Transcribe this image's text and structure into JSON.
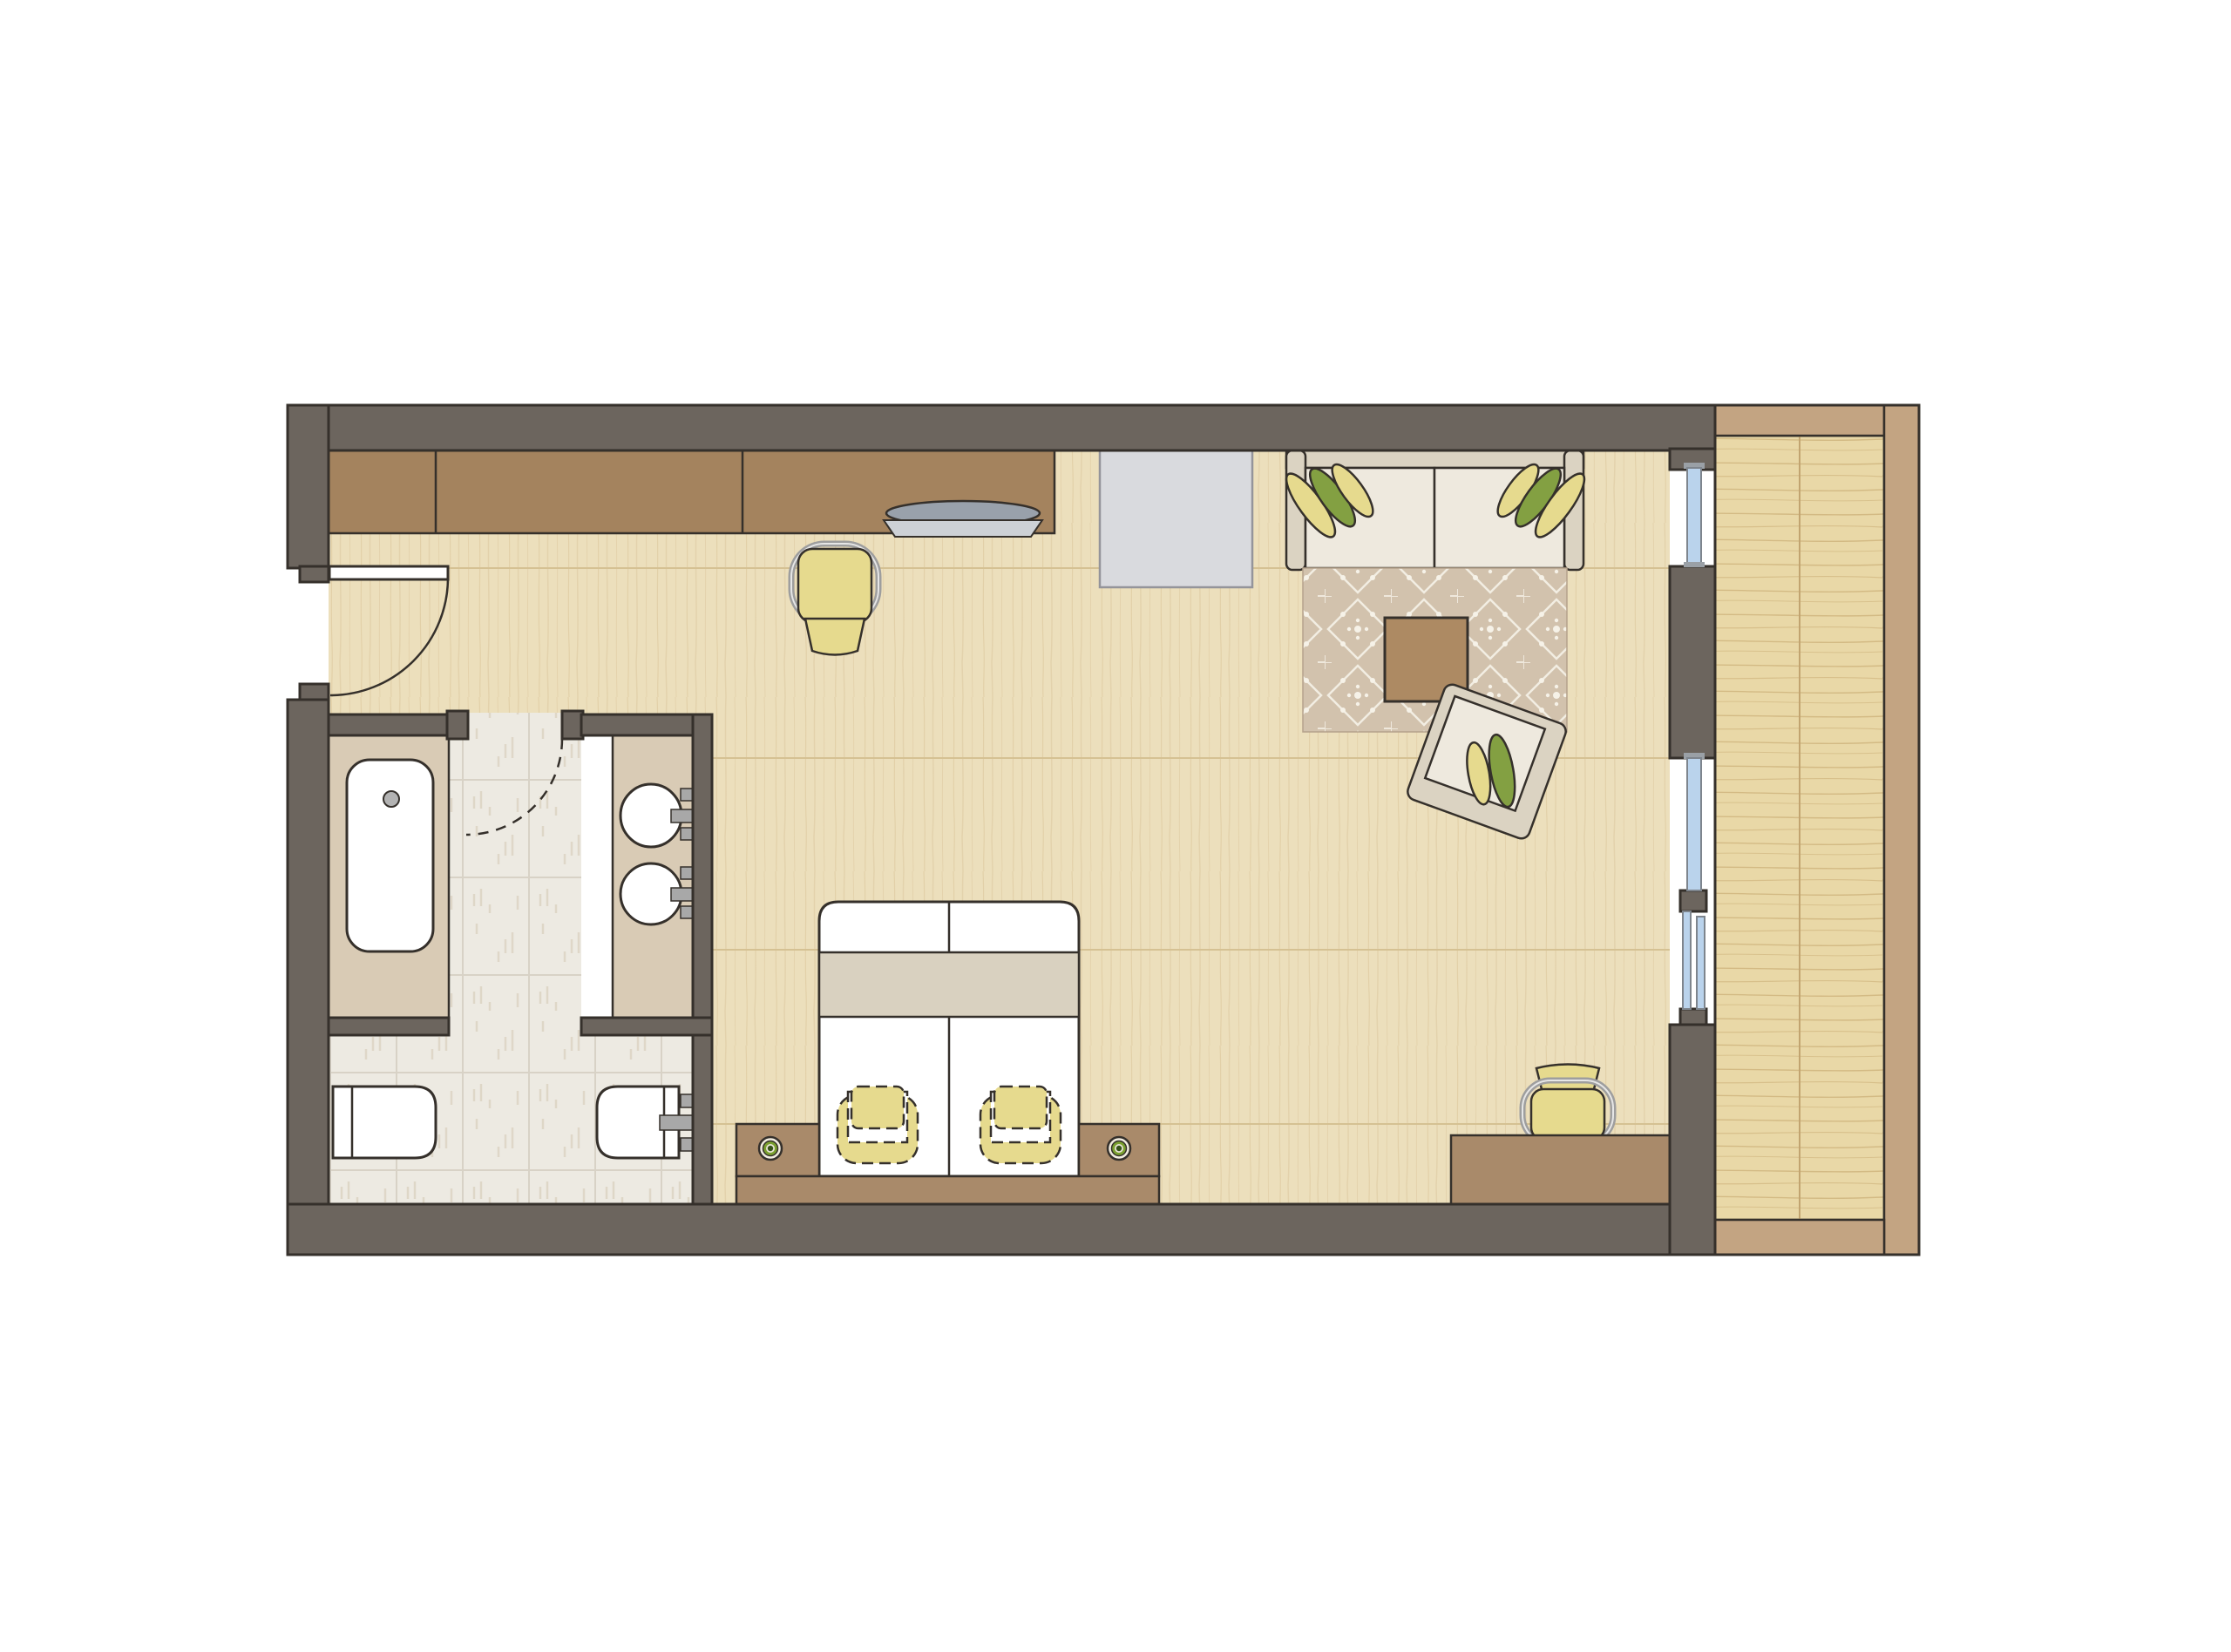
{
  "meta": {
    "title": "Hotel Room Floor Plan",
    "kind": "architectural-top-view",
    "has_text": false
  },
  "colors": {
    "wall": "#6C655E",
    "outline": "#35302B",
    "floor": "#ECDFBC",
    "floor_seam": "#D5C193",
    "tile": "#EDEAE2",
    "grout": "#D8D2C6",
    "deck": "#E9D8A7",
    "deck_grain": "#C8AA72",
    "balcony_rail": "#C3A482",
    "wood": "#A98A6A",
    "wood_dark": "#A4835E",
    "fabric_frame": "#DBD3C2",
    "cushion": "#EEE9DE",
    "rug": "#D2C2AD",
    "rug_motif": "#F6F2E8",
    "yellow": "#E6DA8E",
    "green": "#83A042",
    "chrome": "#9E9E9E",
    "glass": "#BAD3EC",
    "glass_frame": "#7E858D",
    "tan": "#D9CBB5",
    "gray_rack": "#D9DADE",
    "lamp_green": "#7AA02F",
    "lamp_core": "#36511A",
    "band": "#D9D1C0",
    "white": "#FFFFFF"
  },
  "scene": {
    "rooms": [
      {
        "id": "living-bedroom",
        "label": "Living / sleeping room with wood floor"
      },
      {
        "id": "bathroom",
        "label": "Bathroom with tub, double vanity, toilet and bidet"
      },
      {
        "id": "entry",
        "label": "Entry area with swing door"
      },
      {
        "id": "balcony",
        "label": "Balcony with wood decking and railing"
      }
    ],
    "openings": [
      {
        "id": "entry-door",
        "label": "Entry swing door with arc",
        "type": "hinged"
      },
      {
        "id": "bathroom-door",
        "label": "Bathroom door shown as dashed swing arc",
        "type": "hinged-dashed"
      },
      {
        "id": "window-upper",
        "label": "Fixed glazing upper segment"
      },
      {
        "id": "window-lower",
        "label": "Fixed glazing lower segment"
      },
      {
        "id": "balcony-sliding-door",
        "label": "Sliding glass door to balcony"
      },
      {
        "id": "window-pillar",
        "label": "Wall pier between glazing segments"
      }
    ],
    "furniture": [
      {
        "id": "wardrobe",
        "label": "Wardrobe / closet run along top wall",
        "sections": 3
      },
      {
        "id": "desk-top-wall",
        "label": "Desk section of counter with laptop"
      },
      {
        "id": "laptop",
        "label": "Open laptop on desk"
      },
      {
        "id": "desk-chair-top",
        "label": "Yellow desk chair with chrome frame"
      },
      {
        "id": "luggage-rack",
        "label": "Gray luggage bench / cabinet against top wall"
      },
      {
        "id": "sofa",
        "label": "Two-seat sofa with 6 decorative cushions"
      },
      {
        "id": "rug",
        "label": "Patterned area rug with diamond motif"
      },
      {
        "id": "coffee-table",
        "label": "Square wooden coffee table"
      },
      {
        "id": "armchair",
        "label": "Rotated armchair with 2 cushions"
      },
      {
        "id": "bed",
        "label": "Double bed, two duvets, runner band, 2 pillows"
      },
      {
        "id": "nightstand-left",
        "label": "Left nightstand with lamp"
      },
      {
        "id": "nightstand-right",
        "label": "Right nightstand with lamp"
      },
      {
        "id": "headboard",
        "label": "Headboard board along bottom wall"
      },
      {
        "id": "desk-bottom-right",
        "label": "Writing desk at bottom right"
      },
      {
        "id": "desk-chair-bottom",
        "label": "Yellow chair at bottom-right desk"
      }
    ],
    "bathroom_fixtures": [
      {
        "id": "bathtub",
        "label": "Bathtub on tan platform with drain"
      },
      {
        "id": "vanity",
        "label": "Vanity counter with two round basins and wall faucets"
      },
      {
        "id": "bidet",
        "label": "Bidet, bottom-left of bathroom"
      },
      {
        "id": "toilet",
        "label": "Wall-hung toilet with flush plate, bottom-right"
      }
    ],
    "cushion_colors": [
      "#E6DA8E",
      "#83A042"
    ],
    "lamp_colors": [
      "#F2EDE1",
      "#7AA02F",
      "#36511A"
    ]
  }
}
